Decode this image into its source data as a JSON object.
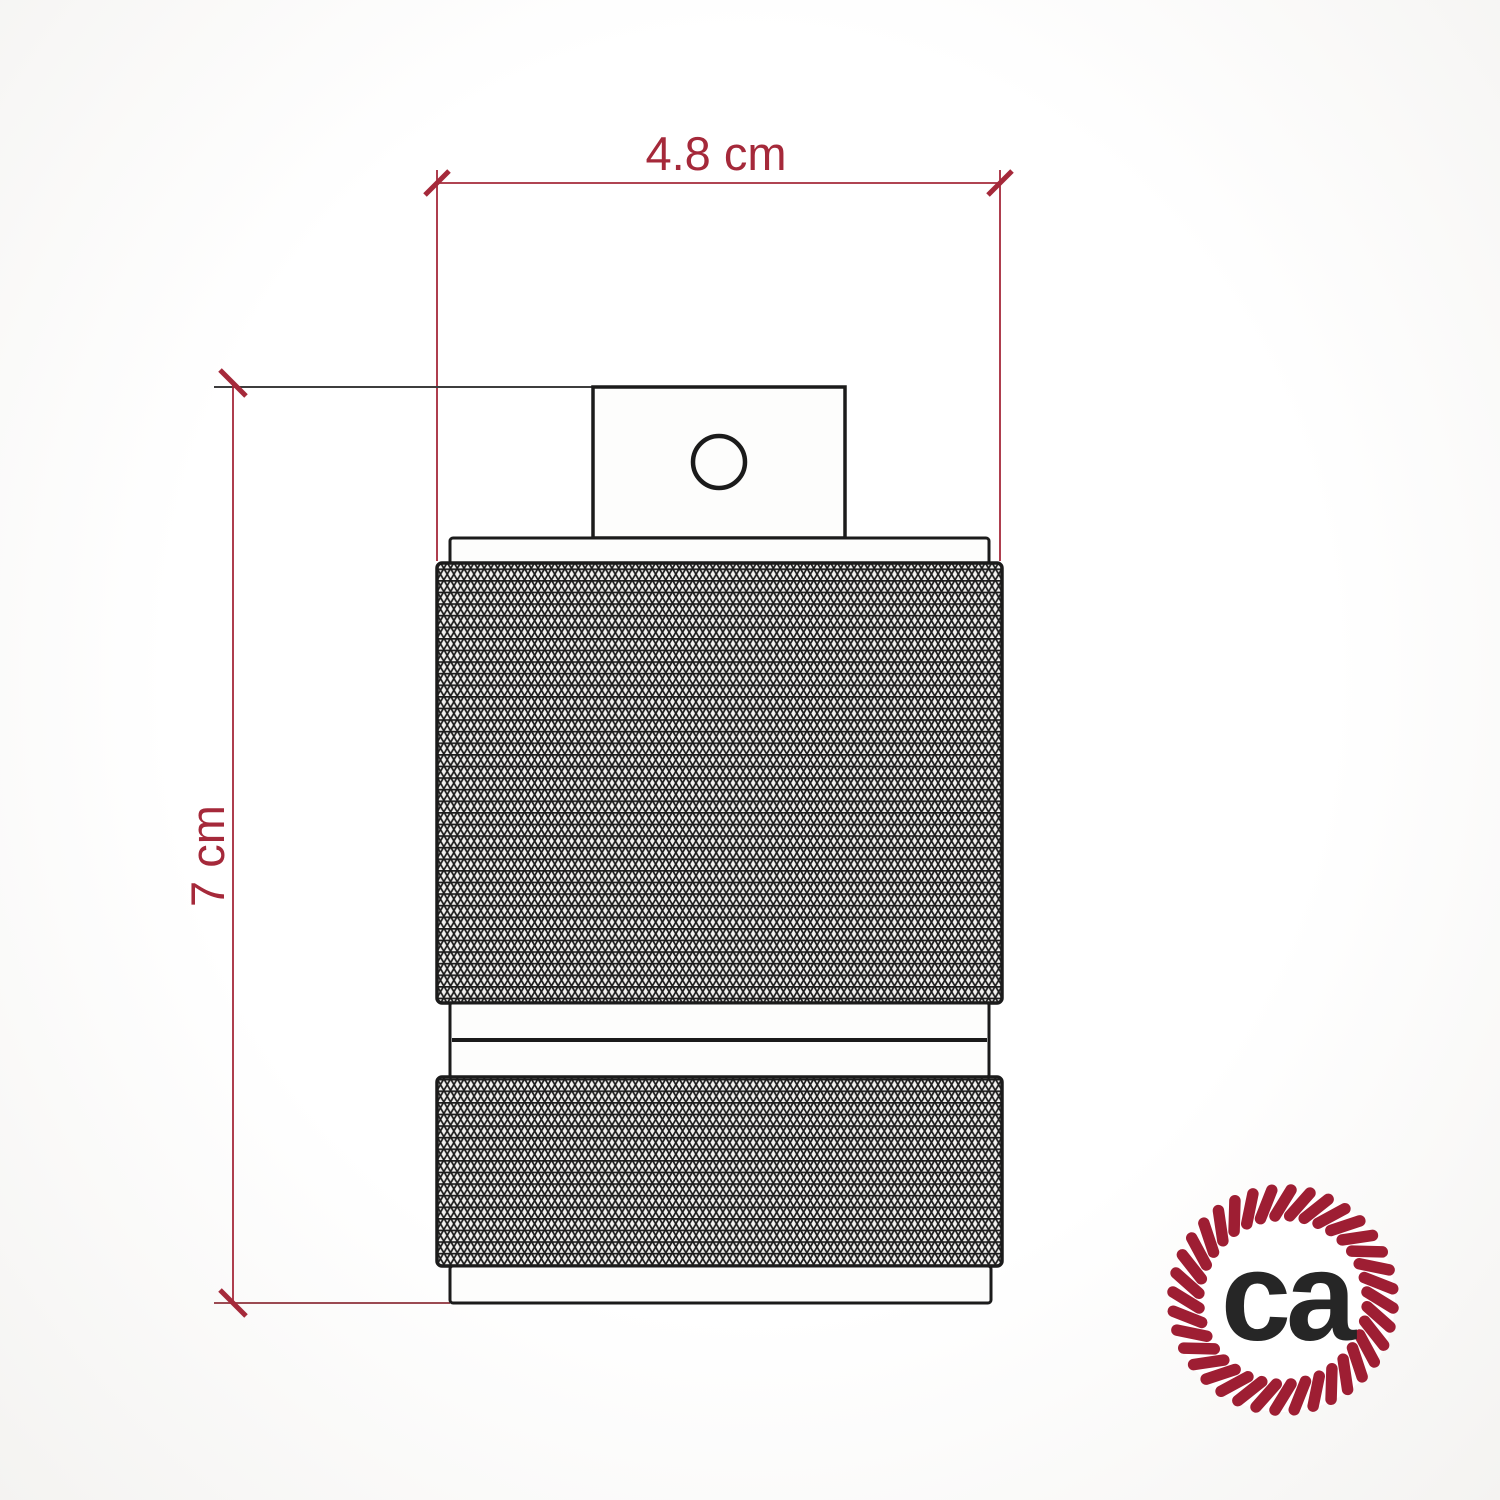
{
  "dimensions": {
    "width_label": "4.8 cm",
    "height_label": "7 cm",
    "accent_color": "#a5293a",
    "extension_top_color": "#3d3d3d",
    "extension_bottom_color": "#9b4a52"
  },
  "drawing": {
    "outline_color": "#1b1b1b",
    "knurl_line_color": "#1c1c1c",
    "knurl_bg_color": "#f2f1ef",
    "body_fill_color": "#fdfdfc"
  },
  "logo": {
    "text": "ca",
    "rope_color": "#9e1e33",
    "text_color": "#262626"
  }
}
